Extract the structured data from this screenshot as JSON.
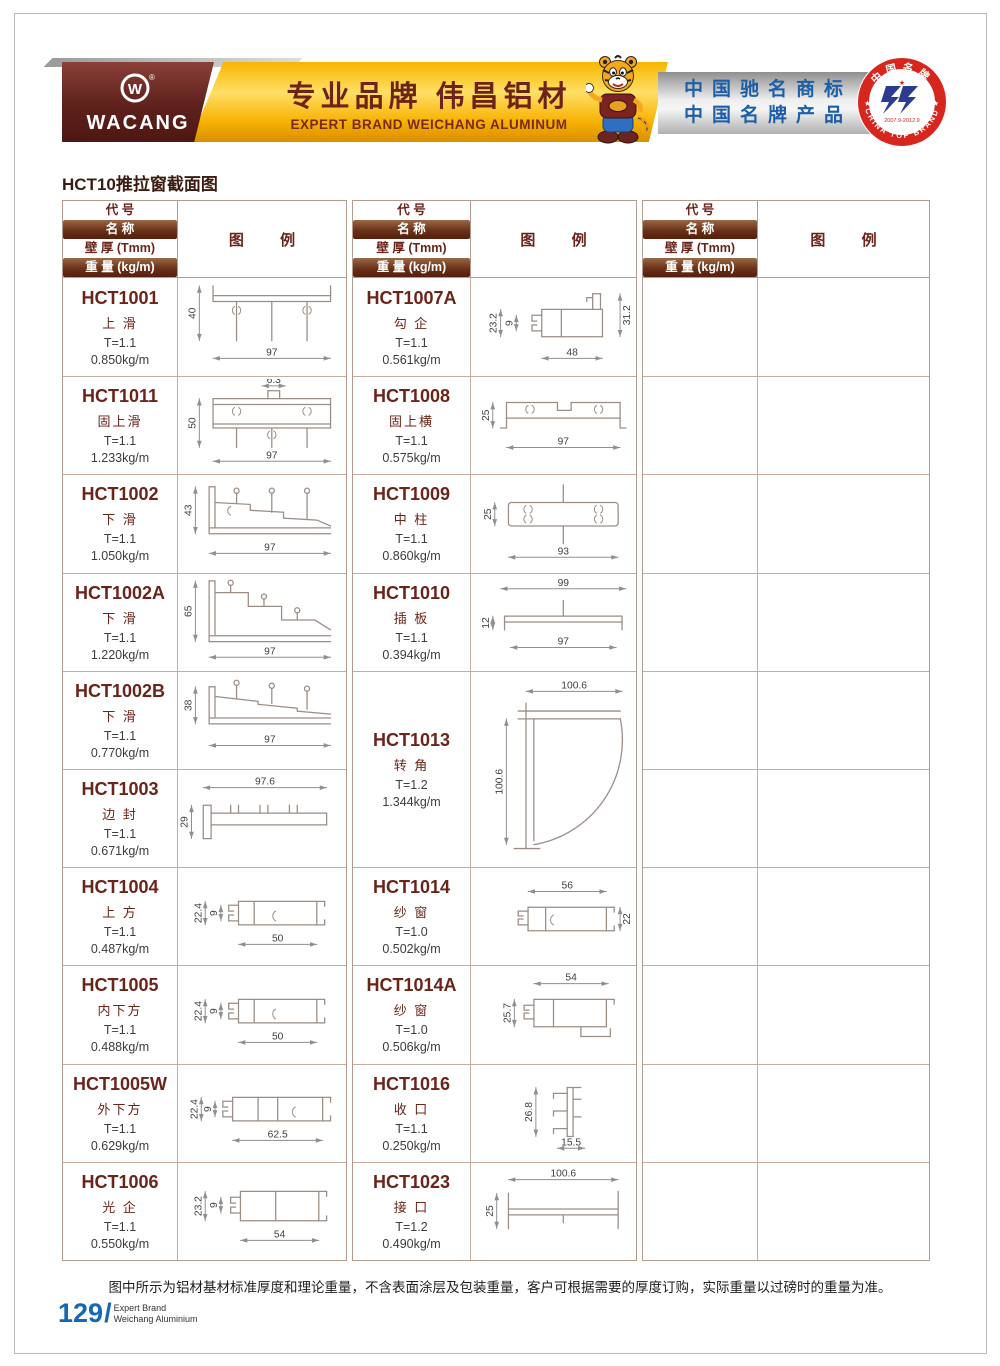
{
  "header": {
    "logo_text": "WACANG",
    "logo_reg": "®",
    "banner_cn": "专业品牌  伟昌铝材",
    "banner_en": "EXPERT BRAND WEICHANG ALUMINUM",
    "silver_line1": "中国驰名商标",
    "silver_line2": "中国名牌产品",
    "badge_top": "中国名牌",
    "badge_bottom": "CHINA TOP BRAND",
    "badge_date": "2007.9-2012.9"
  },
  "page": {
    "title": "HCT10推拉窗截面图",
    "footer_note": "图中所示为铝材基材标准厚度和理论重量，不含表面涂层及包装重量，客户可根据需要的厚度订购，实际重量以过磅时的重量为准。",
    "page_number": "129",
    "page_number_slash": "/",
    "brand_line1": "Expert Brand",
    "brand_line2": "Weichang Aluminium"
  },
  "table_header": {
    "code": "代 号",
    "name": "名 称",
    "thickness": "壁 厚 (Tmm)",
    "weight": "重 量 (kg/m)",
    "legend": "图  例"
  },
  "colors": {
    "maroon": "#6b241a",
    "banner_yellow": "#f7b500",
    "silver_text_blue": "#1c5fa8",
    "badge_red": "#d7261d",
    "page_number_blue": "#1668b3",
    "drawing_line": "#9a8e86"
  },
  "products": [
    {
      "code": "HCT1001",
      "name": "上 滑",
      "thickness": "T=1.1",
      "weight": "0.850kg/m",
      "dims": {
        "left": "40",
        "bottom": "97"
      }
    },
    {
      "code": "HCT1011",
      "name": "固上滑",
      "thickness": "T=1.1",
      "weight": "1.233kg/m",
      "dims": {
        "top": "6.3",
        "left": "50",
        "bottom": "97"
      }
    },
    {
      "code": "HCT1002",
      "name": "下 滑",
      "thickness": "T=1.1",
      "weight": "1.050kg/m",
      "dims": {
        "left": "43",
        "bottom": "97"
      }
    },
    {
      "code": "HCT1002A",
      "name": "下 滑",
      "thickness": "T=1.1",
      "weight": "1.220kg/m",
      "dims": {
        "left": "65",
        "bottom": "97"
      }
    },
    {
      "code": "HCT1002B",
      "name": "下 滑",
      "thickness": "T=1.1",
      "weight": "0.770kg/m",
      "dims": {
        "left": "38",
        "bottom": "97"
      }
    },
    {
      "code": "HCT1003",
      "name": "边 封",
      "thickness": "T=1.1",
      "weight": "0.671kg/m",
      "dims": {
        "top": "97.6",
        "left": "29"
      }
    },
    {
      "code": "HCT1004",
      "name": "上 方",
      "thickness": "T=1.1",
      "weight": "0.487kg/m",
      "dims": {
        "left": "22.4",
        "inner": "9",
        "bottom": "50"
      }
    },
    {
      "code": "HCT1005",
      "name": "内下方",
      "thickness": "T=1.1",
      "weight": "0.488kg/m",
      "dims": {
        "left": "22.4",
        "inner": "9",
        "bottom": "50"
      }
    },
    {
      "code": "HCT1005W",
      "name": "外下方",
      "thickness": "T=1.1",
      "weight": "0.629kg/m",
      "dims": {
        "left": "22.4",
        "inner": "9",
        "bottom": "62.5"
      }
    },
    {
      "code": "HCT1006",
      "name": "光 企",
      "thickness": "T=1.1",
      "weight": "0.550kg/m",
      "dims": {
        "left": "23.2",
        "inner": "9",
        "bottom": "54"
      }
    },
    {
      "code": "HCT1007A",
      "name": "勾 企",
      "thickness": "T=1.1",
      "weight": "0.561kg/m",
      "dims": {
        "left": "23.2",
        "inner": "9",
        "right": "31.2",
        "bottom": "48"
      }
    },
    {
      "code": "HCT1008",
      "name": "固上横",
      "thickness": "T=1.1",
      "weight": "0.575kg/m",
      "dims": {
        "left": "25",
        "bottom": "97"
      }
    },
    {
      "code": "HCT1009",
      "name": "中 柱",
      "thickness": "T=1.1",
      "weight": "0.860kg/m",
      "dims": {
        "left": "25",
        "bottom": "93"
      }
    },
    {
      "code": "HCT1010",
      "name": "插 板",
      "thickness": "T=1.1",
      "weight": "0.394kg/m",
      "dims": {
        "top": "99",
        "left": "12",
        "bottom": "97"
      }
    },
    {
      "code": "HCT1013",
      "name": "转 角",
      "thickness": "T=1.2",
      "weight": "1.344kg/m",
      "dims": {
        "top": "100.6",
        "left": "100.6"
      }
    },
    {
      "code": "HCT1014",
      "name": "纱 窗",
      "thickness": "T=1.0",
      "weight": "0.502kg/m",
      "dims": {
        "top": "56",
        "right": "22"
      }
    },
    {
      "code": "HCT1014A",
      "name": "纱 窗",
      "thickness": "T=1.0",
      "weight": "0.506kg/m",
      "dims": {
        "top": "54",
        "left": "25.7"
      }
    },
    {
      "code": "HCT1016",
      "name": "收 口",
      "thickness": "T=1.1",
      "weight": "0.250kg/m",
      "dims": {
        "left": "26.8",
        "bottom": "15.5"
      }
    },
    {
      "code": "HCT1023",
      "name": "接 口",
      "thickness": "T=1.2",
      "weight": "0.490kg/m",
      "dims": {
        "top": "100.6",
        "left": "25"
      }
    }
  ]
}
